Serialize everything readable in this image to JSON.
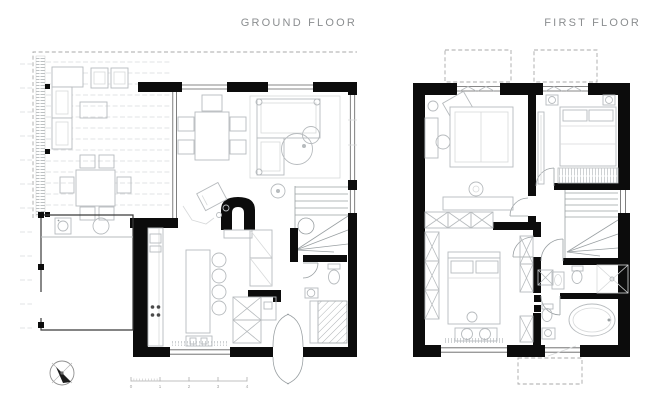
{
  "titles": {
    "ground_floor": "GROUND FLOOR",
    "first_floor": "FIRST FLOOR"
  },
  "scale_bar": {
    "unit_labels": [
      "0",
      "1",
      "2",
      "3",
      "4"
    ]
  },
  "colors": {
    "background": "#ffffff",
    "walls": "#0c0c0c",
    "furniture_line": "#b7bbbe",
    "dashed_line": "#a8a8a8",
    "title_text": "#8b8e90"
  },
  "icons": {
    "compass": "north-arrow"
  }
}
